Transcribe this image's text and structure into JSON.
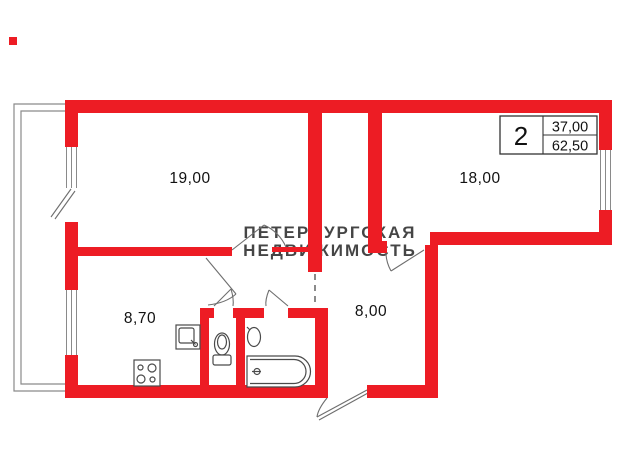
{
  "floor_plan": {
    "room_labels": {
      "living": "19,00",
      "bedroom": "18,00",
      "kitchen": "8,70",
      "hall": "8,00"
    },
    "info_table": {
      "rooms_count": "2",
      "living_area": "37,00",
      "total_area": "62,50"
    },
    "watermark": {
      "line1": "ПЕТЕРБУРГСКАЯ",
      "line2": "НЕДВИЖИМОСТЬ"
    },
    "colors": {
      "wall_red": "#ed1c24",
      "line_gray": "#8a8a8a",
      "door_gray": "#6e6e6e",
      "fixture_gray": "#4a4a4a",
      "table_border": "#333333"
    }
  }
}
